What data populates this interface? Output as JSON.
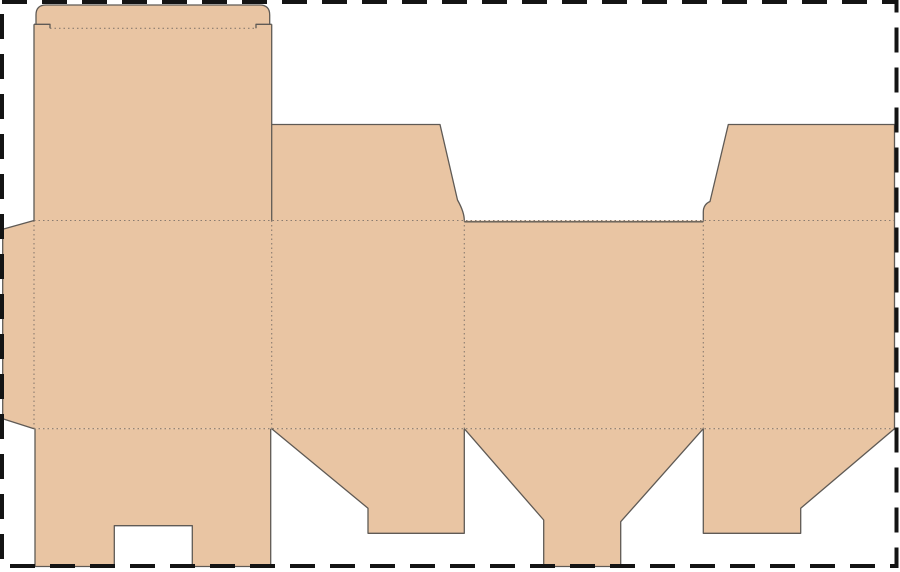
{
  "page": {
    "title": "Carton dieline template (tuck-top, snap-lock bottom)",
    "canvas": {
      "width": 900,
      "height": 572
    },
    "background": "#ffffff"
  },
  "colors": {
    "background": "#ffffff",
    "board_fill": "#e9c5a3",
    "cut_line": "#5f5a55",
    "fold_line": "#8a7c70",
    "page_border": "#141414"
  },
  "styles": {
    "cut_width": 1.3,
    "fold_width": 1.1,
    "fold_dash": "1.5 3",
    "border_width": 4,
    "border_dash": "25 15"
  },
  "page_border": {
    "x": 2,
    "y": 2,
    "width": 894.5,
    "height": 564
  },
  "dieline": {
    "panels": [
      {
        "name": "tuck-flap",
        "d": "M 36,15 Q 36,5 46,5 L 259.7,5 Q 269.7,5 269.7,15 L 269.7,28.3 L 36,28.3 Z"
      },
      {
        "name": "lid-panel",
        "d": "M 34,24.3 L 271.7,24.3 L 271.7,220.5 L 34,220.5 Z"
      },
      {
        "name": "dust-flap-top-left",
        "d": "M 271.7,124.5 L 440,124.5 L 457.5,200 Q 464.3,212 464.3,220.5 L 271.7,220.5 Z"
      },
      {
        "name": "dust-flap-top-right",
        "d": "M 728.3,124.5 L 894.5,124.5 L 894.5,220.5 L 703.3,220.5 L 703.3,212 Q 703.3,204.5 710,201.5 Z"
      },
      {
        "name": "body-band-with-glue-tab",
        "d": "M 2.7,229.3 L 34,220.5 L 894.5,220.5 L 894.5,428.7 L 34,428.7 L 2.7,418.7 Z"
      },
      {
        "name": "bottom-flap-front",
        "d": "M 35,428.7 L 270.7,428.7 L 270.7,566.5 L 192.3,566.5 L 192.3,525.7 L 114.3,525.7 L 114.3,566.5 L 35,566.5 Z"
      },
      {
        "name": "bottom-flap-side-left",
        "d": "M 271.7,428.7 L 368,508.3 L 368,533.3 L 464.3,533.3 L 464.3,428.7 Z"
      },
      {
        "name": "bottom-lock-flap",
        "d": "M 464.3,428.7 L 703.3,428.7 L 620.7,521.7 L 620.7,566.5 L 543.7,566.5 L 543.7,520 Z"
      },
      {
        "name": "bottom-flap-side-right",
        "d": "M 703.3,428.7 L 703.3,533.3 L 800.7,533.3 L 800.7,508.3 L 894.5,428.7 Z"
      }
    ],
    "fold_lines": [
      {
        "name": "tuck-fold",
        "d": "M 50,28.3 L 256,28.3"
      },
      {
        "name": "top-horizontal-fold",
        "d": "M 34,220.5 L 894.5,220.5"
      },
      {
        "name": "bottom-horizontal-fold",
        "d": "M 34,428.7 L 894.5,428.7"
      },
      {
        "name": "glue-tab-fold",
        "d": "M 34,220.5 L 34,428.7"
      },
      {
        "name": "panel-fold-1",
        "d": "M 271.7,220.5 L 271.7,428.7"
      },
      {
        "name": "panel-fold-2",
        "d": "M 464.3,220.5 L 464.3,428.7"
      },
      {
        "name": "panel-fold-3",
        "d": "M 703.3,220.5 L 703.3,428.7"
      }
    ],
    "cut_lines": [
      {
        "name": "tuck-flap-cut",
        "d": "M 36,24.3 L 36,15 Q 36,5 46,5 L 259.7,5 Q 269.7,5 269.7,15 L 269.7,24.3"
      },
      {
        "name": "tuck-shoulder-left-cut",
        "d": "M 34,24.3 L 50,24.3 L 50,28.3"
      },
      {
        "name": "tuck-shoulder-right-cut",
        "d": "M 271.7,24.3 L 256,24.3 L 256,28.3"
      },
      {
        "name": "lid-left-edge-cut",
        "d": "M 34,24.3 L 34,220.5"
      },
      {
        "name": "lid-right-edge-cut",
        "d": "M 271.7,24.3 L 271.7,220.5"
      },
      {
        "name": "dust-flap-top-left-cut",
        "d": "M 271.7,124.5 L 440,124.5 L 457.5,200 Q 464.3,212 464.3,220.5"
      },
      {
        "name": "back-panel-top-edge-cut",
        "d": "M 464.3,221.8 L 703.3,221.8"
      },
      {
        "name": "dust-flap-top-right-cut",
        "d": "M 703.3,220.5 L 703.3,212 Q 703.3,204.5 710,201.5 L 728.3,124.5 L 894.5,124.5 L 894.5,220.5"
      },
      {
        "name": "right-side-edge-cut",
        "d": "M 894.5,220.5 L 894.5,428.7"
      },
      {
        "name": "glue-tab-cut",
        "d": "M 34,220.5 L 2.7,229.3 L 2.7,418.7 L 34,428.7"
      },
      {
        "name": "bottom-flap-front-cut",
        "d": "M 35,428.7 L 35,566.5 L 114.3,566.5 L 114.3,525.7 L 192.3,525.7 L 192.3,566.5 L 270.7,566.5 L 270.7,428.7"
      },
      {
        "name": "bottom-flap-side-left-cut",
        "d": "M 271.7,428.7 L 368,508.3 L 368,533.3 L 464.3,533.3 L 464.3,428.7"
      },
      {
        "name": "bottom-lock-flap-cut",
        "d": "M 464.3,428.7 L 543.7,520 L 543.7,566.5 L 620.7,566.5 L 620.7,521.7 L 703.3,428.7"
      },
      {
        "name": "bottom-flap-side-right-cut",
        "d": "M 703.3,428.7 L 703.3,533.3 L 800.7,533.3 L 800.7,508.3 L 894.5,428.7"
      }
    ]
  }
}
